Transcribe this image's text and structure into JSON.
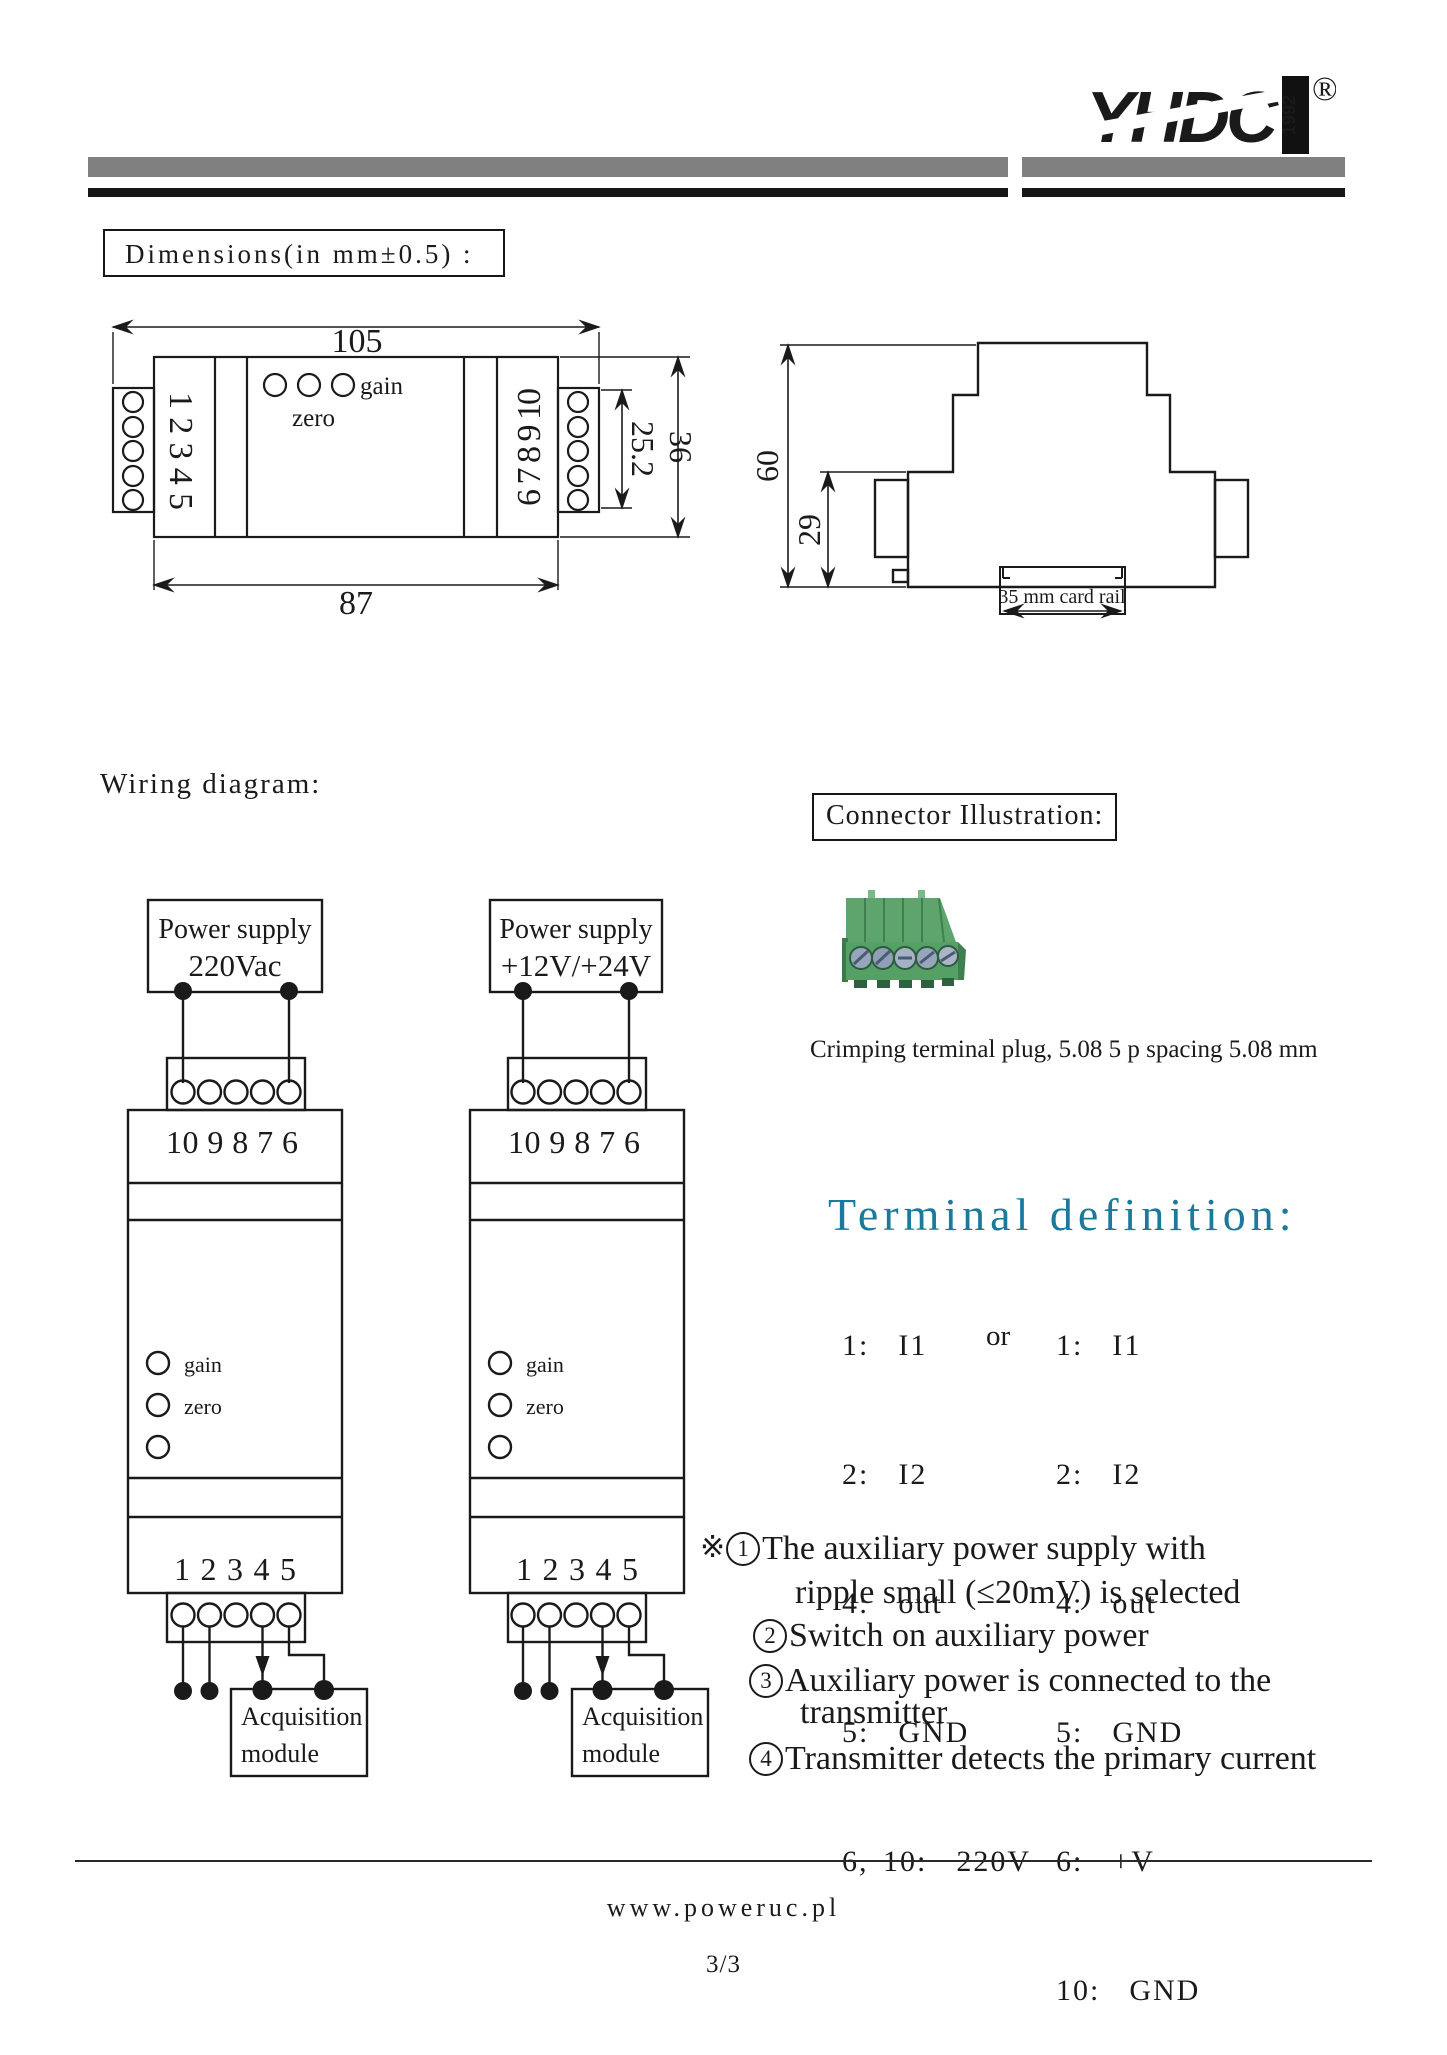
{
  "header": {
    "logo_text": "YHDC",
    "logo_year": "1992",
    "registered_mark": "®"
  },
  "dimensions": {
    "title": "Dimensions(in mm±0.5) :",
    "front": {
      "overall_width": "105",
      "body_width": "87",
      "terminals_left": "1 2 3 4 5",
      "terminals_right": "6 7 8 9 10",
      "gain_label": "gain",
      "zero_label": "zero",
      "terminal_height": "25.2",
      "body_height": "36"
    },
    "side": {
      "overall_height": "60",
      "lower_height": "29",
      "rail_label": "35 mm card rail"
    }
  },
  "wiring": {
    "title": "Wiring diagram:",
    "left": {
      "supply_title": "Power supply",
      "supply_value": "220Vac",
      "top_terminals": "10 9 8 7 6",
      "gain_label": "gain",
      "zero_label": "zero",
      "bottom_terminals": "1 2 3 4 5",
      "module_line1": "Acquisition",
      "module_line2": "module"
    },
    "right": {
      "supply_title": "Power supply",
      "supply_value": "+12V/+24V",
      "top_terminals": "10 9 8 7 6",
      "gain_label": "gain",
      "zero_label": "zero",
      "bottom_terminals": "1 2 3 4 5",
      "module_line1": "Acquisition",
      "module_line2": "module"
    }
  },
  "connector": {
    "title": "Connector Illustration:",
    "caption": "Crimping terminal plug, 5.08 5 p spacing  5.08 mm"
  },
  "terminal_definition": {
    "title": "Terminal definition:",
    "left_rows": [
      "1:  I1",
      "2:  I2",
      "4:  out",
      "5:  GND",
      "6, 10:  220V"
    ],
    "or_label": "or",
    "right_rows": [
      "1:  I1",
      "2:  I2",
      "4:  out",
      "5:  GND",
      "6:  +V",
      "10:  GND"
    ]
  },
  "notes": {
    "prefix": "※",
    "items": [
      {
        "num": "1",
        "line1": "The auxiliary power supply with",
        "line2": "ripple small (≤20mV) is selected"
      },
      {
        "num": "2",
        "line1": "Switch on auxiliary power",
        "line2": ""
      },
      {
        "num": "3",
        "line1": "Auxiliary power is connected to the",
        "line2": "transmitter"
      },
      {
        "num": "4",
        "line1": "Transmitter detects the primary current",
        "line2": ""
      }
    ]
  },
  "footer": {
    "website": "www.poweruc.pl",
    "page": "3/3"
  },
  "colors": {
    "accent_teal": "#1b7a9c",
    "bar_gray": "#808080",
    "connector_green": "#55a067"
  }
}
